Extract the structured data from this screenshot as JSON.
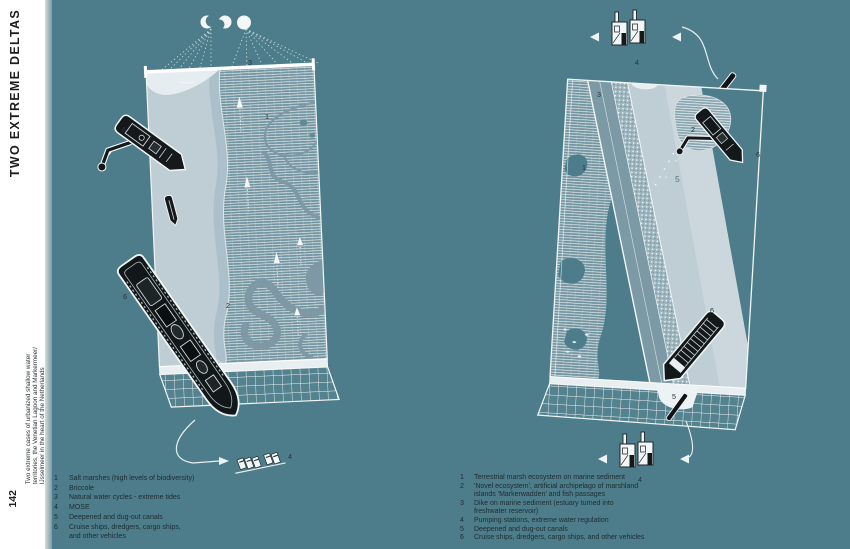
{
  "page": {
    "background": "#4d7d8a"
  },
  "sidebar": {
    "title": "TWO EXTREME DELTAS",
    "subtitle_lines": [
      "Two extreme cases of urbanized shallow water",
      "territories, the Venetian Lagoon and Markermeer/",
      "IJsselmeer in the heart of the Netherlands"
    ],
    "page_number": "142"
  },
  "left_figure": {
    "labels": {
      "tides": "3",
      "salt_marshes": "1",
      "briccole": "2",
      "dredger": "6",
      "cruise_ship": "6",
      "canal": "5",
      "mose": "4"
    },
    "legend": [
      {
        "num": "1",
        "lines": [
          "Salt marshes (high levels of biodiversity)"
        ]
      },
      {
        "num": "2",
        "lines": [
          "Briccole"
        ]
      },
      {
        "num": "3",
        "lines": [
          "Natural water cycles - extreme tides"
        ]
      },
      {
        "num": "4",
        "lines": [
          "MOSE"
        ]
      },
      {
        "num": "5",
        "lines": [
          "Deepened and dug-out canals"
        ]
      },
      {
        "num": "6",
        "lines": [
          "Cruise ships, dredgers, cargo ships,",
          "and other vehicles"
        ]
      }
    ]
  },
  "right_figure": {
    "labels": {
      "pumping_top": "4",
      "dike": "3",
      "marsh": "1",
      "markerwadden": "2",
      "channel": "5",
      "dredger": "6",
      "cargo_ship": "6",
      "canal_section": "5",
      "pumping_bottom": "4"
    },
    "legend": [
      {
        "num": "1",
        "lines": [
          "Terrestrial marsh ecosystem on marine sediment"
        ]
      },
      {
        "num": "2",
        "lines": [
          "'Novel ecosystem', artificial archipelago of marshland",
          "islands 'Markerwadden' and fish passages"
        ]
      },
      {
        "num": "3",
        "lines": [
          "Dike on marine sediment (estuary turned into",
          "freshwater reservoir)"
        ]
      },
      {
        "num": "4",
        "lines": [
          "Pumping stations, extreme water regulation"
        ]
      },
      {
        "num": "5",
        "lines": [
          "Deepened and dug-out canals"
        ]
      },
      {
        "num": "6",
        "lines": [
          "Cruise ships, dredgers, cargo ships, and other vehicles"
        ]
      }
    ]
  },
  "icons": {
    "moon_phases": "crescent, gibbous and full moon circles",
    "mose_barrier": "row of white flap gates",
    "pumping_station": "white building with chimney",
    "arrow": "white triangle arrowhead",
    "dredger": "black ship with excavator arm",
    "cruise_ship": "black elongated hull",
    "cargo_ship": "black hull with container grid",
    "sailboat": "white triangle with dashed wake",
    "briccole": "white pole marker with dotted trail"
  },
  "colors": {
    "background": "#4d7d8a",
    "paper": "#ffffff",
    "water_light": "#bfcdd5",
    "water_band": "#abc0ca",
    "marsh": "#6f929e",
    "channel_dark": "#7e99a5",
    "dike_crest": "#7b9aa5",
    "riprap": "#9eb5be",
    "grid_face": "#54828e",
    "face_light": "#e9eef1",
    "ink": "#22333a",
    "ship_black": "#13181a",
    "white_line": "#f2f6f7"
  }
}
